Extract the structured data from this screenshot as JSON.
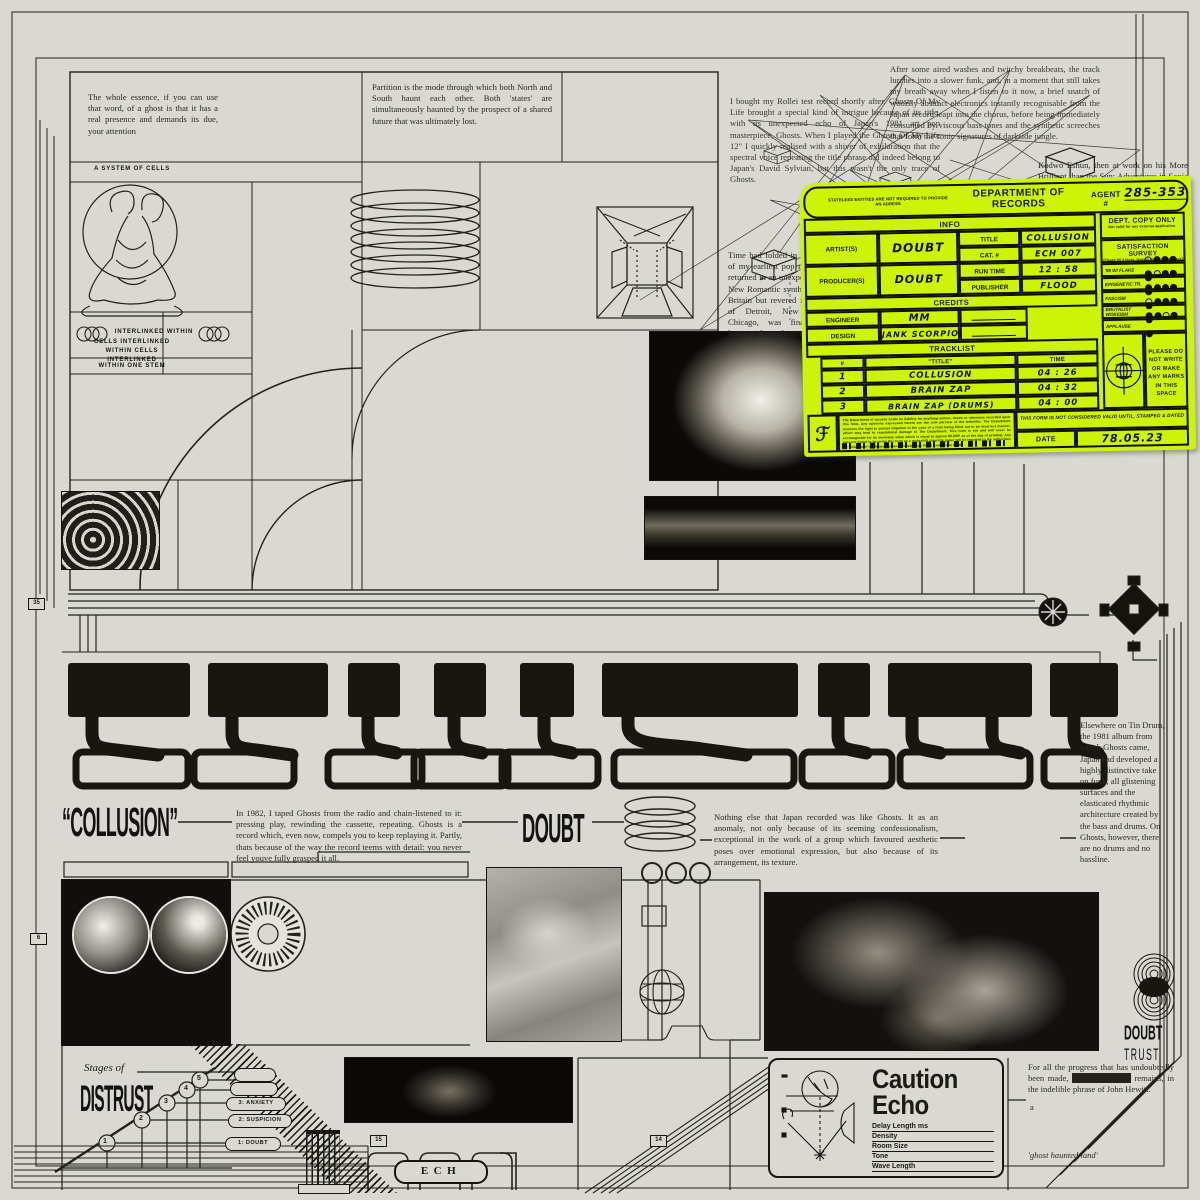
{
  "top_left": {
    "para_essence": "The whole essence, if you can use that word, of a ghost is that it has a real presence and demands its due, your attention",
    "para_partition": "Partition is the mode through which both North and South haunt each other. Both 'states' are simultaneously haunted by the prospect of a shared future that was ultimately lost.",
    "label_system": "A SYSTEM OF CELLS",
    "label_interlinked": "INTERLINKED WITHIN",
    "label_cells": "CELLS INTERLINKED WITHIN CELLS INTERLINKED",
    "label_stem": "WITHIN ONE STEM"
  },
  "top_right": {
    "para_breakbeats": "After some aired washes and twitchy breakbeats, the track lurches into a slower funk, and, in a moment that still takes my breath away when I listen to it now, a brief snatch of woozily abstract electronics instantly recognisable from the Japan record leapt into the chorus, before being immediately consumed by viscous bass tones and the synthetic screeches that form the sonic signatures of darkside jungle.",
    "para_rollei": "I bought my Rollei test record shortly after. Ghosts Of My Life brought a special kind of intrigue because of its title, with its unexpected echo of Japan's 1981 art pop masterpiece, Ghosts. When I played the Ghosts Of My Life 12\" I quickly realised with a shiver of exhilaration that the spectral voice repeating the title phrase did indeed belong to Japan's David Sylvian, but this wasn't the only trace of Ghosts.",
    "para_kodwo": "Kodwo Eshun, then at work on his More Brilliant than the Sun: Adventures in Sonic Fiction, would argue that synthpop played",
    "para_time": "Time had folded in on itself: one of my earliest pop memories had returned in an unexpected context. New Romantic synthpop, made in Britain but revered in the techno of Detroit, New York and Chicago, was finally coming home to the underground."
  },
  "form": {
    "header": {
      "small_print": "STATELESS ENTITIES ARE NOT REQUIRED TO PROVIDE AN ADRESS",
      "title": "DEPARTMENT OF RECORDS",
      "agent_label": "AGENT #",
      "agent_number": "285-353"
    },
    "info": {
      "section_title": "INFO",
      "artist_label": "ARTIST(S)",
      "artist_value": "DOUBT",
      "title_label": "TITLE",
      "title_value": "COLLUSION",
      "cat_label": "CAT. #",
      "cat_value": "ECH 007",
      "producer_label": "PRODUCER(S)",
      "producer_value": "DOUBT",
      "runtime_label": "RUN TIME",
      "runtime_value": "12 : 58",
      "publisher_label": "PUBLISHER",
      "publisher_value": "FLOOD"
    },
    "credits": {
      "section_title": "CREDITS",
      "engineer_label": "ENGINEER",
      "engineer_value": "MM",
      "design_label": "DESIGN",
      "design_value": "JANK SCORPIO"
    },
    "tracklist": {
      "section_title": "TRACKLIST",
      "col_num": "#",
      "col_title": "\"TITLE\"",
      "col_time": "TIME",
      "rows": [
        {
          "num": "1",
          "title": "COLLUSION",
          "time": "04 : 26"
        },
        {
          "num": "2",
          "title": "BRAIN ZAP",
          "time": "04 : 32"
        },
        {
          "num": "3",
          "title": "BRAIN ZAP (DRUMS)",
          "time": "04 : 00"
        }
      ]
    },
    "dept_copy": {
      "title": "DEPT. COPY ONLY",
      "sub": "Not valid for any external application."
    },
    "survey": {
      "title": "SATISFACTION SURVEY",
      "sub": "(Please fill 4 faces, leaving most relevant face)",
      "rows": [
        {
          "label": "'99 W/ FLAKE",
          "faces": [
            "outline",
            "filled",
            "filled",
            "filled",
            "filled"
          ]
        },
        {
          "label": "EPIGENETIC TR.",
          "faces": [
            "filled",
            "outline",
            "filled",
            "filled",
            "filled"
          ]
        },
        {
          "label": "FASCISM",
          "faces": [
            "filled",
            "filled",
            "filled",
            "filled",
            "filled"
          ]
        },
        {
          "label": "BRUTALIST WOKEISM",
          "faces": [
            "outline",
            "filled",
            "filled",
            "filled",
            "filled"
          ]
        },
        {
          "label": "APPLAUSE",
          "faces": [
            "filled",
            "filled",
            "outline",
            "filled",
            "filled"
          ]
        }
      ]
    },
    "no_marks": "PLEASE DO NOT WRITE OR MAKE ANY MARKS IN THIS SPACE",
    "valid_note": "THIS FORM IS NOT CONSIDERED VALID UNTIL, STAMPED & DATED",
    "date_label": "DATE",
    "date_value": "78.05.23",
    "monogram": "ℱ",
    "fine_print": "The Department of records holds no liability for anything written, drawn or otherwise recorded upon this form. Any opinions expressed herein are the sole perview of the beholder. The Department reserves the right to pursue litigation in the case of a form being filled out in an incorrect manner, which may lead to reputational damage to The Department. This form is not and will never be exchangeable for its monetary value which is equal to approx $0.003* as of the day of printing. Any persons found to be using this form as a makeshift cigarette paper will be reported to the authorities for violation of His Majesties Secret Lavatorials Penal Code Order PP88."
  },
  "mid": {
    "collusion_quoted": "“COLLUSION”",
    "doubt": "DOUBT",
    "para_1982": "In 1982, I taped Ghosts from the radio and chain-listened to it: pressing play, rewinding the cassette, repeating. Ghosts is a record which, even now, compels you to keep replaying it. Partly, thats because of the way the record teems with detail: you never feel youve fully grasped it all.",
    "para_nothing": "Nothing else that Japan recorded was like Ghosts. It as an anomaly, not only because of its seeming confessionalism, exceptional in the work of a group which favoured aesthetic poses over emotional expression, but also because of its arrangement, its texture.",
    "para_tindrum": "Elsewhere on Tin Drum, the 1981 album from which Ghosts came, Japan had developed a highly distinctive take on funk, all glistening surfaces and the elasticated rhythmic architecture created by the bass and drums. On Ghosts, however, there are no drums and no bassline."
  },
  "bottom": {
    "stages_label": "Stages of",
    "distrust": "DISTRUST",
    "stage_numbers": [
      "1",
      "2",
      "3",
      "4",
      "5"
    ],
    "stage_pills": [
      "1: DOUBT",
      "2: SUSPICION",
      "3: ANXIETY"
    ],
    "ech": "ECH",
    "caution_line1": "Caution",
    "caution_line2": "Echo",
    "echo_params": [
      "Delay Length ms",
      "Density",
      "Room Size",
      "Tone",
      "Wave Length"
    ],
    "doubt_trust_top": "DOUBT",
    "doubt_trust_bottom": "TRUST",
    "para_progress_pre": "For all the progress that has undoubtedly been made,",
    "para_progress_redacted": "Northern Ireland",
    "para_progress_post": "remains, in the indelible phrase of John Hewitt.",
    "para_progress_a": "a",
    "ghost_quote": "'ghost  haunted land'"
  },
  "markers": {
    "n35": "35",
    "n6": "6",
    "n15": "15",
    "n14": "14"
  },
  "colors": {
    "paper": "#d9d8d3",
    "ink": "#16150f",
    "neon": "#cdf407"
  }
}
